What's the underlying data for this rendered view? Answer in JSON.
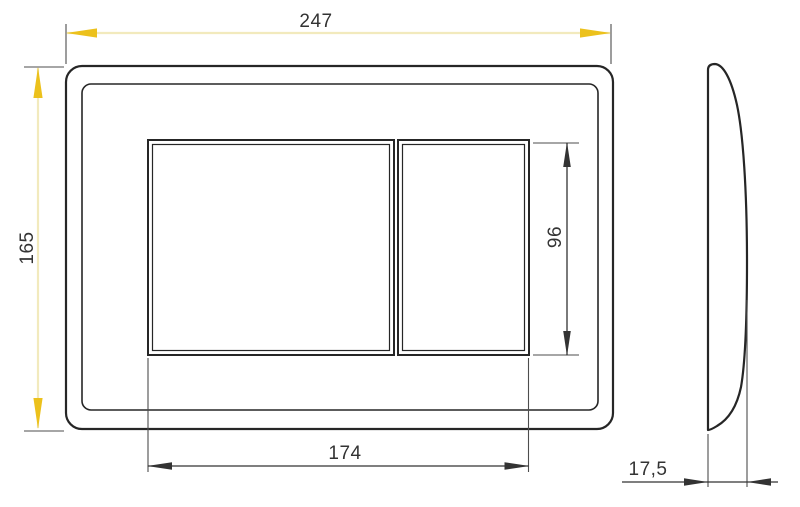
{
  "drawing": {
    "dims": {
      "overall_width": "247",
      "overall_height": "165",
      "buttons_width": "174",
      "buttons_height": "96",
      "thickness": "17,5"
    }
  },
  "colors": {
    "background": "#ffffff",
    "line": "#262626",
    "ext_line": "#4d4d4d",
    "dim_line": "#333333",
    "text": "#333333",
    "accent_arrow": "#ecc11c",
    "accent_line": "#f2eabd"
  }
}
